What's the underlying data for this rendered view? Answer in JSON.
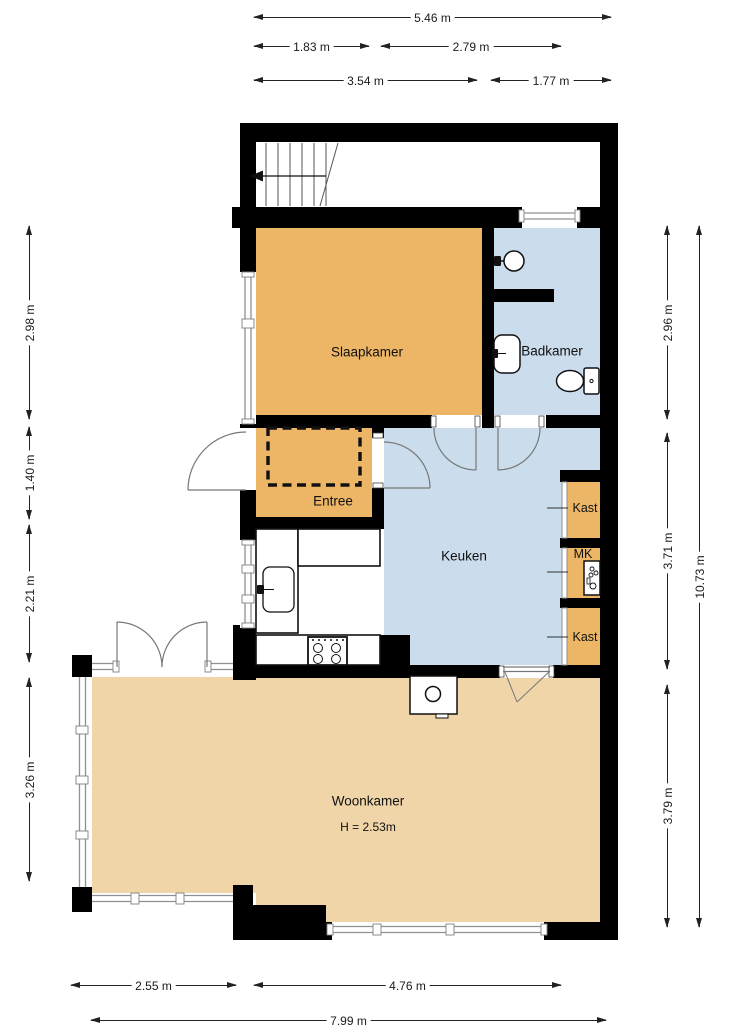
{
  "title": "Floor plan",
  "rooms": {
    "slaapkamer": "Slaapkamer",
    "badkamer": "Badkamer",
    "entree": "Entree",
    "keuken": "Keuken",
    "kast_top": "Kast",
    "mk": "MK",
    "kast_bottom": "Kast",
    "woonkamer": "Woonkamer",
    "woonkamer_height": "H = 2.53m"
  },
  "dimensions": {
    "top": [
      "5.46 m",
      "1.83 m",
      "2.79 m",
      "3.54 m",
      "1.77 m"
    ],
    "left": [
      "2.98 m",
      "1.40 m",
      "2.21 m",
      "3.26 m"
    ],
    "right": [
      "2.96 m",
      "3.71 m",
      "3.79 m",
      "10.73 m"
    ],
    "bottom": [
      "2.55 m",
      "4.76 m",
      "7.99 m"
    ]
  },
  "colors": {
    "room_orange": "#ecb666",
    "room_tan": "#f0d5a9",
    "room_blue": "#cbdcec",
    "wall": "#000000",
    "glass": "#909090",
    "door_arc": "#777777"
  },
  "icons": {
    "stairs": "stairs-up-arrow",
    "shower": "shower-head",
    "sink_bath": "washbasin",
    "toilet": "toilet",
    "sink_kitchen": "kitchen-sink",
    "stove": "gas-hob-4-burners",
    "meter_box": "electric-meter-panel",
    "fireplace": "fireplace-unit"
  }
}
